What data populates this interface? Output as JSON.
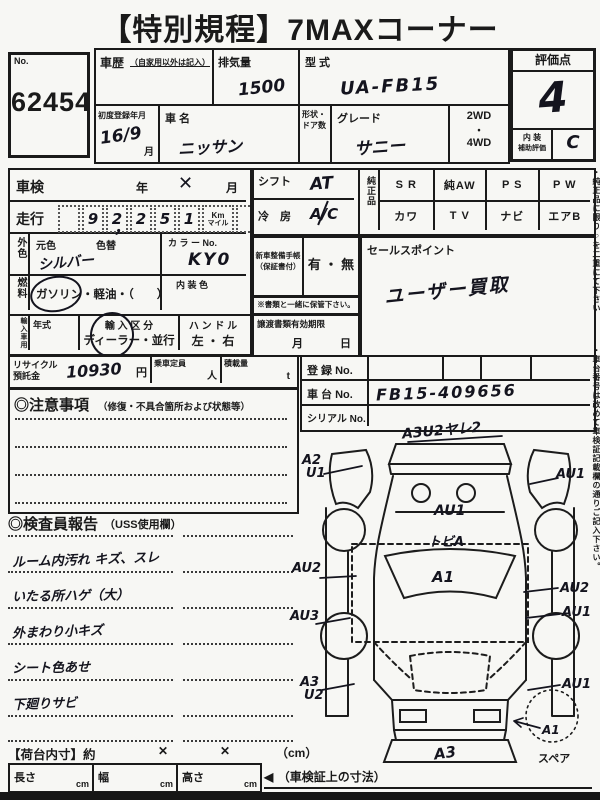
{
  "title": "【特別規程】7MAXコーナー",
  "lot": {
    "label": "No.",
    "number": "62454"
  },
  "header": {
    "history_label": "車歴",
    "history_note": "（自家用以外は記入）",
    "displacement_label": "排気量",
    "displacement_value": "1500",
    "model_code_label": "型 式",
    "model_code_value": "UA-FB15",
    "first_reg_label": "初度登録年月",
    "first_reg_value": "16/9",
    "first_reg_unit": "月",
    "make_label": "車 名",
    "make_value": "ニッサン",
    "body_door_label": "形状・ドア数",
    "grade_label": "グレード",
    "grade_value": "サニー",
    "drive_top": "2WD",
    "drive_mid": "・",
    "drive_bottom": "4WD"
  },
  "rating": {
    "title": "評価点",
    "score": "4",
    "interior_line1": "内 装",
    "interior_line2": "補助評価",
    "interior_value": "C"
  },
  "inspection": {
    "shaken_label": "車検",
    "year_label": "年",
    "shaken_mark": "✕",
    "month_label": "月",
    "mileage_label": "走行",
    "digits": [
      "9",
      "2",
      "2",
      "5",
      "1"
    ],
    "comma": "，",
    "unit_km": "Km",
    "unit_mile": "マイル",
    "ext_color_label": "外色",
    "base_color_label": "元色",
    "repaint_label": "色替",
    "ext_color_value": "シルバー",
    "color_no_label": "カ ラ ー No.",
    "color_no_value": "KY0",
    "fuel_label": "燃料",
    "fuel_options": "ガソリン・軽油・（　　）",
    "int_color_label": "内 装 色"
  },
  "import_box": {
    "label": "輸入車用",
    "year_type_label": "年式",
    "class_label": "輸 入 区 分",
    "class_options": "ディーラー・並行",
    "handle_label": "ハ ン ド ル",
    "handle_options": "左 ・ 右"
  },
  "recycle": {
    "label1": "リサイクル",
    "label2": "預託金",
    "value": "10930",
    "unit": "円",
    "capacity_label": "乗車定員",
    "capacity_unit": "人",
    "load_label": "積載量",
    "load_unit": "t"
  },
  "cautions": {
    "title": "◎注意事項",
    "note": "（修復・不具合箇所および状態等）"
  },
  "inspector": {
    "title": "◎検査員報告",
    "note": "（USS使用欄）",
    "remarks": [
      "ルーム内汚れ キズ、スレ",
      "いたる所ハゲ（大）",
      "外まわり小キズ",
      "シート色あせ",
      "下廻りサビ"
    ]
  },
  "shift": {
    "label": "シフト",
    "value": "AT"
  },
  "aircon": {
    "label": "冷　房",
    "value": "A/C"
  },
  "equipment": {
    "label": "純正品",
    "row1": [
      "S R",
      "純AW",
      "P S",
      "P W"
    ],
    "row2": [
      "カワ",
      "T V",
      "ナビ",
      "エアB"
    ]
  },
  "service_book": {
    "label1": "新車整備手帳",
    "label2": "（保証書付）",
    "options": "有 ・ 無"
  },
  "keep_note": "※書類と一緒に保管下さい。",
  "transfer": {
    "label": "譲渡書類有効期限",
    "month": "月",
    "day": "日"
  },
  "sales": {
    "label": "セールスポイント",
    "value": "ユーザー買取"
  },
  "registry": {
    "reg_label": "登 録 No.",
    "chassis_label": "車 台 No.",
    "chassis_value": "FB15-409656",
    "serial_label": "シリアル No."
  },
  "diagram": {
    "front_note": "A3U2ヤレ2",
    "left_top1": "A2",
    "left_top2": "U1",
    "right_top": "AU1",
    "hood": "AU1",
    "windshield": "トビA",
    "roof": "A1",
    "left_mid": "AU2",
    "right_mid": "AU2",
    "left_low": "AU3",
    "right_low": "AU1",
    "left_bottom1": "A3",
    "left_bottom2": "U2",
    "right_bottom": "AU1",
    "rear_mark": "A1",
    "rear_bumper": "A3",
    "spare": "スペア"
  },
  "cargo": {
    "label": "【荷台内寸】約",
    "x1": "✕",
    "x2": "✕",
    "unit": "（cm）",
    "length_label": "長さ",
    "width_label": "幅",
    "height_label": "高さ",
    "cm": "cm",
    "arrow": "◀",
    "dim_note": "（車検証上の寸法）"
  },
  "side_notes": {
    "note1": "・純正品に限り○を二重にて下さい",
    "note2": "・車台番号は改めて車検証記載欄の通りご記入下さい。"
  },
  "colors": {
    "ink": "#1a1a1a",
    "paper": "#f7f7f4",
    "handwriting": "#14141e"
  }
}
